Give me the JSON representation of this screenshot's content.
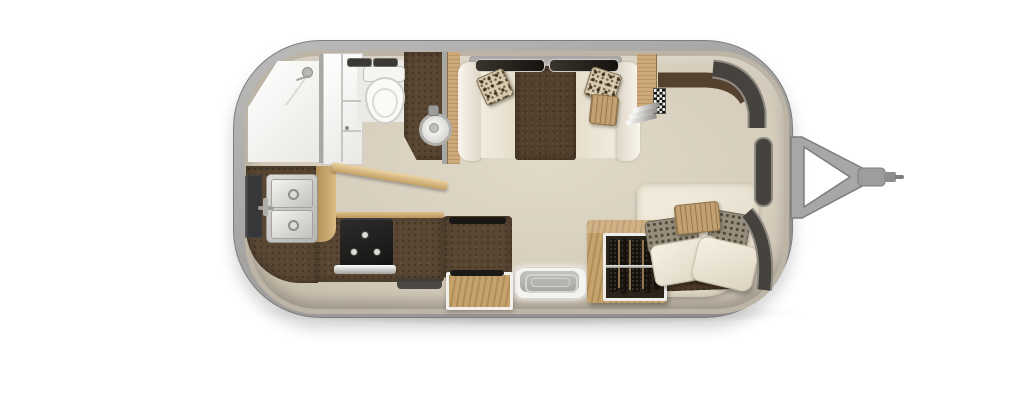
{
  "scene": {
    "title": "Travel trailer floor plan - top-down 3D render with A-frame hitch on the right",
    "text_content": "none",
    "orientation": "rear at left, hitch/front at right"
  },
  "palette": {
    "shellA": "#bcbbb9",
    "shellB": "#8a8987",
    "wall": "#bcb4a5",
    "floorA": "#e2dac9",
    "floorB": "#d6cdbc",
    "floorC": "#c2b9a8",
    "counter": "#5a4733",
    "table": "#53402c",
    "wood": "#cda97a",
    "woodDeep": "#c6a26c",
    "white": "#f4f1ea",
    "cream": "#efe8d9",
    "appliance": "#232220",
    "steel": "#c6c5c2",
    "glass": "#46423d",
    "glassFrame": "#8e8a84",
    "tan": "#c2a072",
    "grayFab": "#968d7c",
    "blanket": "#4b3a26",
    "clothes": "#17120b",
    "mat": "#3f3d3a"
  },
  "rooms": [
    {
      "id": "bathroom",
      "area": "rear-left",
      "fixtures": [
        "shower",
        "shower-head",
        "divider-wall",
        "medicine-cabinet",
        "toilet",
        "roof-vent-slats",
        "vanity-counter",
        "round-vessel-sink",
        "open-bathroom-door"
      ]
    },
    {
      "id": "kitchen",
      "area": "mid-left",
      "fixtures": [
        "refrigerator",
        "kitchen-faucet",
        "double-basin-sink",
        "l-shaped-counter",
        "wood-cabinet-face",
        "three-burner-cooktop",
        "utensil-ledge",
        "dark-floor-mat",
        "counter-console",
        "wood-storage-step-box"
      ]
    },
    {
      "id": "entry",
      "area": "mid-bottom",
      "fixtures": [
        "entry-step-landing"
      ]
    },
    {
      "id": "dinette",
      "area": "mid-top",
      "fixtures": [
        "wall-window-left",
        "wall-window-right",
        "bench-seat-left",
        "bench-seat-right",
        "seat-cushions",
        "dinette-table",
        "print-throw-pillow-left",
        "print-throw-pillow-right",
        "tan-throw-pillow"
      ]
    },
    {
      "id": "bedroom",
      "area": "front-right",
      "fixtures": [
        "wardrobe-upper-cabinet",
        "checkered-media-panel",
        "wall-shelves-x3",
        "headboard-bolster",
        "bed-mattress",
        "brown-bedspread",
        "tan-pillow",
        "print-pillow-x2",
        "white-pillow-x2",
        "open-hanging-closet-with-rod-and-clothes"
      ]
    },
    {
      "id": "exterior",
      "fixtures": [
        "aluminum-shell",
        "front-curved-window-upper",
        "front-window-mid",
        "front-curved-window-lower",
        "a-frame-hitch",
        "hitch-coupler"
      ]
    }
  ]
}
